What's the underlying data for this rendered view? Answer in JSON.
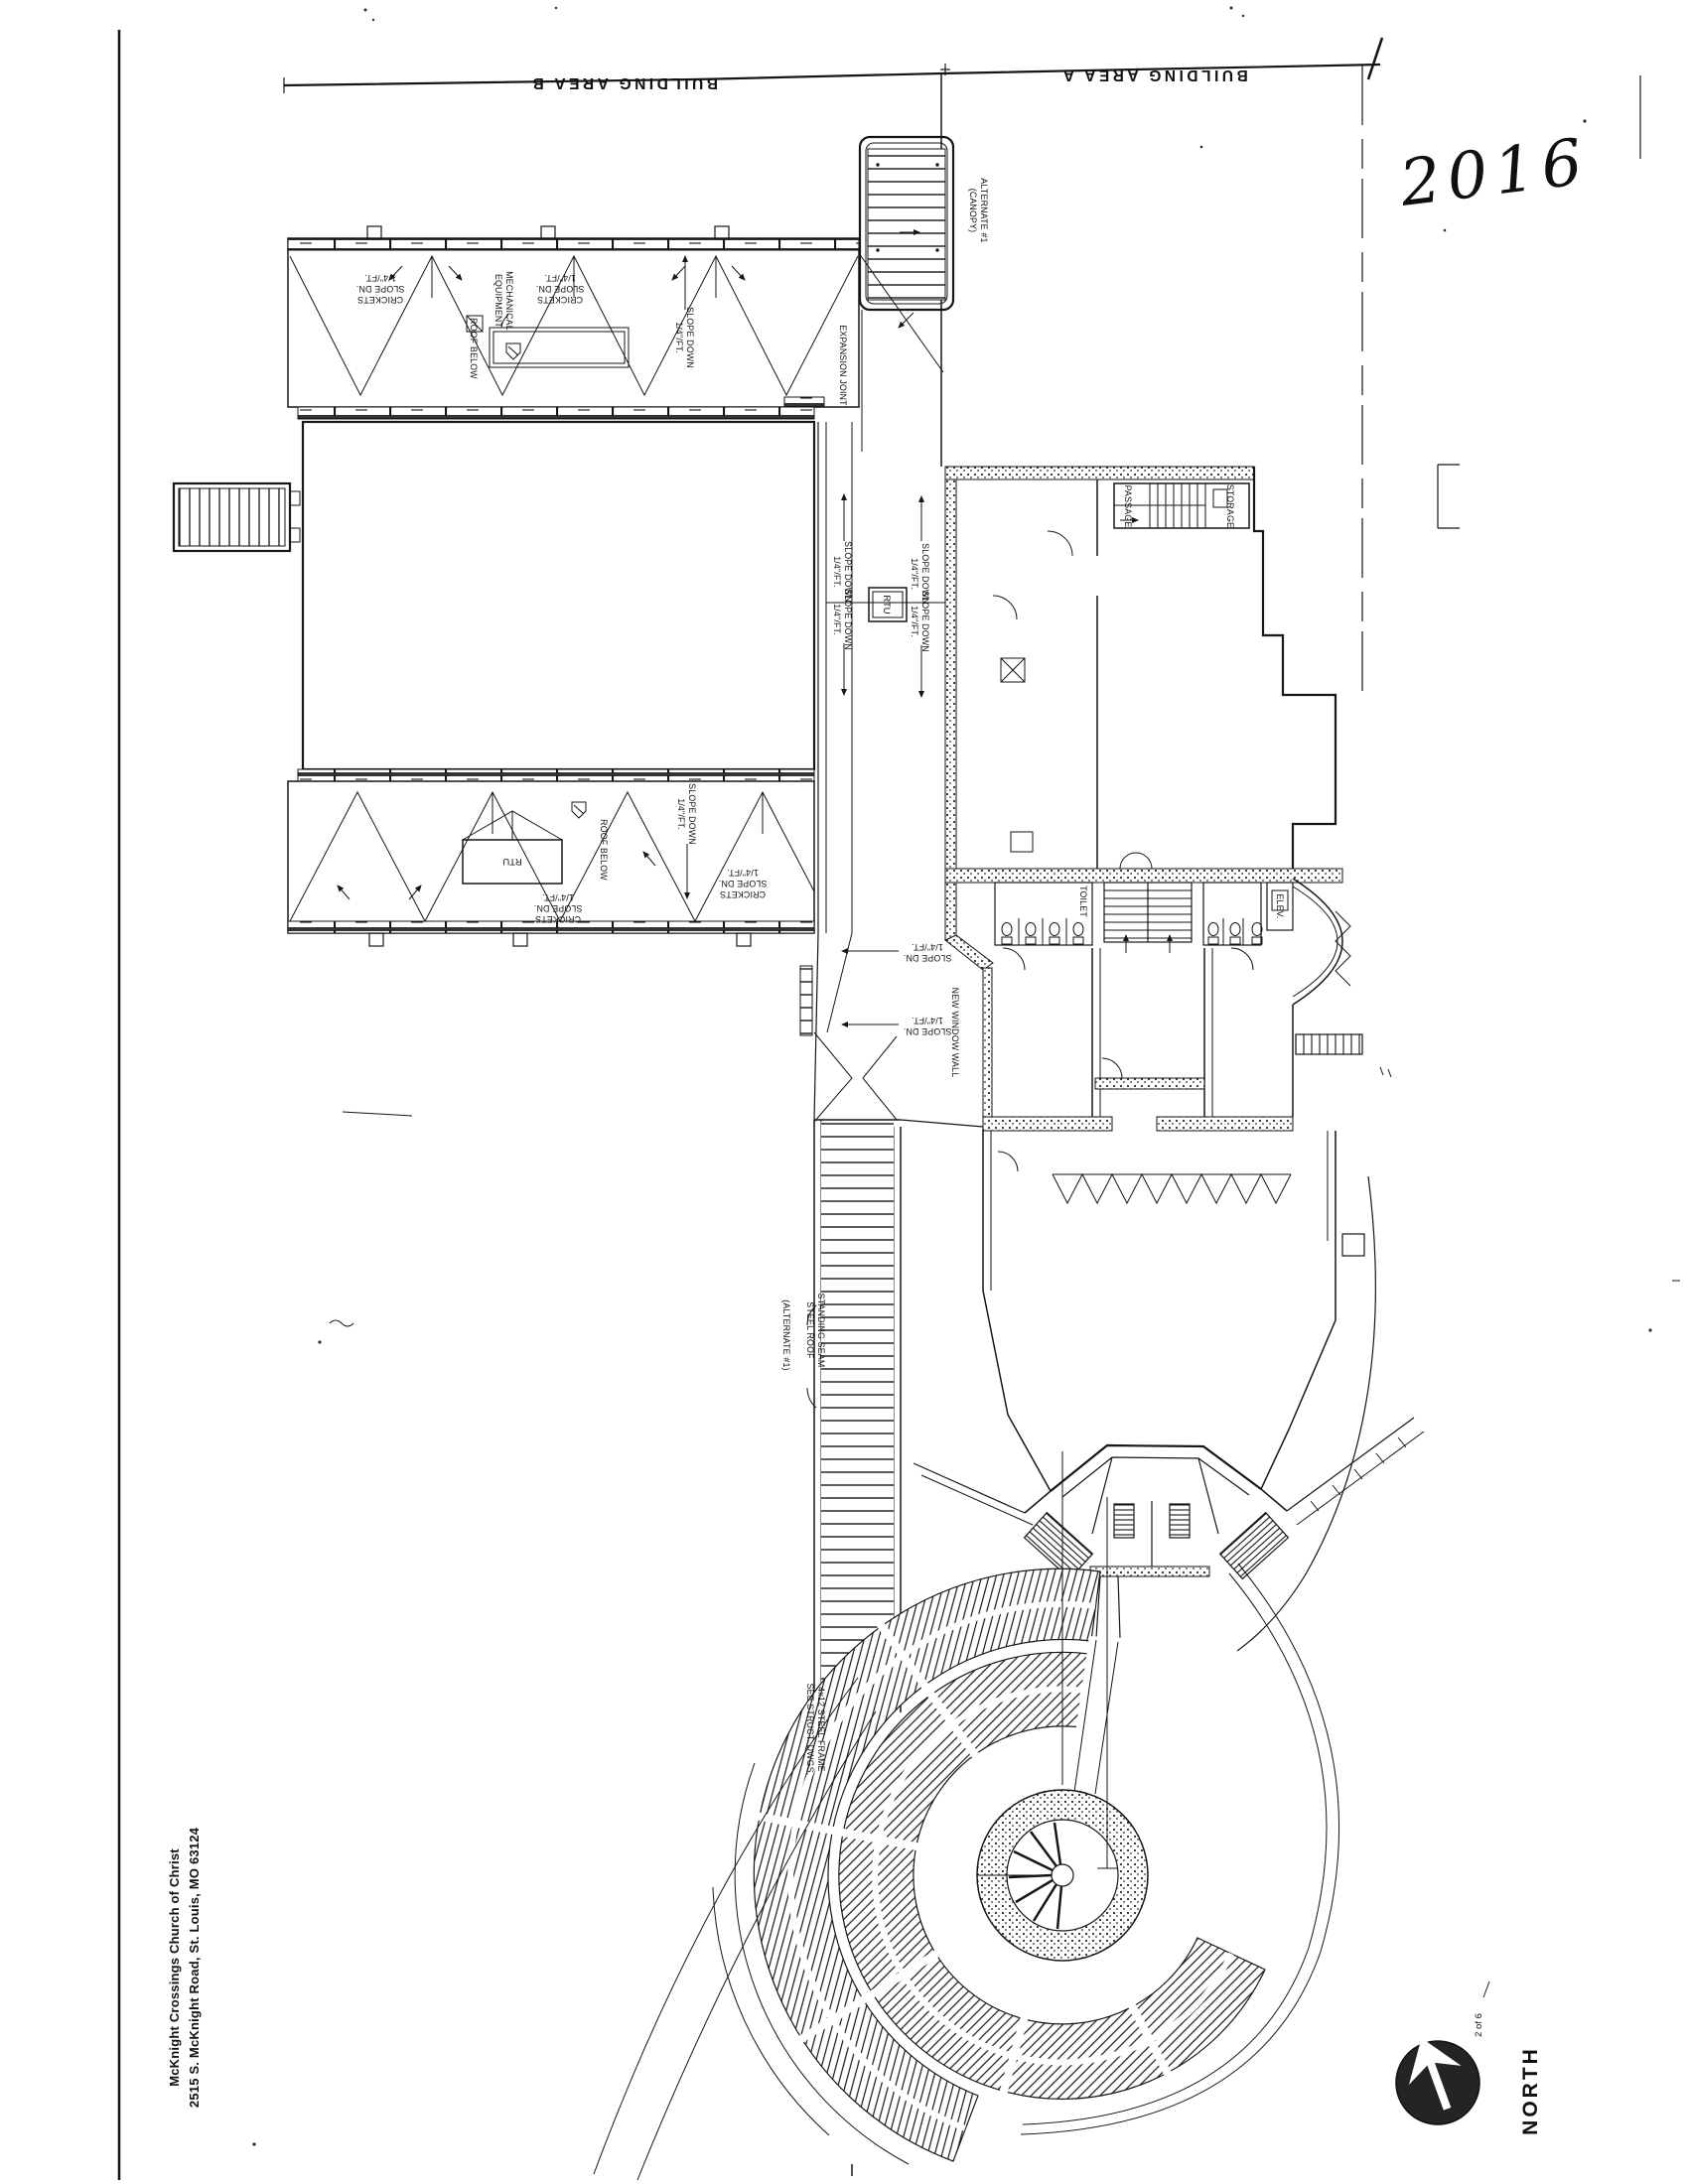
{
  "meta": {
    "document_type": "scanned architectural roof and site plan",
    "ink_color": "#161616",
    "paper_color": "#ffffff"
  },
  "page": {
    "year_handwritten": "2016",
    "sheet_note": "2 of 6",
    "north_label": "NORTH",
    "title_block": {
      "line1": "McKnight Crossings Church of Christ",
      "line2": "2515 S. McKnight Road, St. Louis, MO 63124"
    }
  },
  "areas": {
    "area_b": "BUILDING AREA B",
    "area_a": "BUILDING AREA A"
  },
  "labels": {
    "crickets": "CRICKETS",
    "slope_dn": "SLOPE DN.",
    "quarter_per_ft": "1/4\"/FT.",
    "slope_down": "SLOPE DOWN",
    "mechanical": "MECHANICAL",
    "equipment": "EQUIPMENT",
    "roof_below": "ROOF BELOW",
    "expansion_joint": "EXPANSION JOINT",
    "rtu": "RTU",
    "alternate1": "ALTERNATE #1",
    "canopy_paren": "(CANOPY)",
    "alternate1_paren": "(ALTERNATE #1)",
    "standing_seam": "STANDING SEAM",
    "steel_roof": "STEEL ROOF",
    "steel_frame_1": "4x12 STEEL FRAME",
    "steel_frame_2": "SEE STRUCT. DWGS.",
    "new_window_wall": "NEW WINDOW WALL",
    "storage": "STORAGE",
    "passage": "PASSAGE",
    "toilet": "TOILET",
    "elev": "ELEV."
  }
}
